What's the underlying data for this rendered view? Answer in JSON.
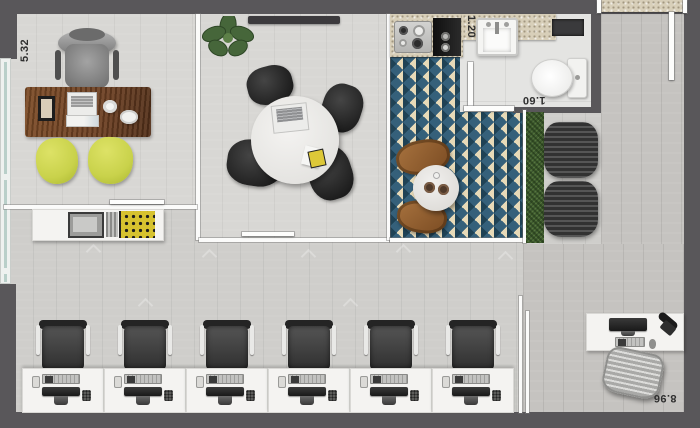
{
  "dimension_labels": {
    "office_width": "5.32",
    "bathroom_width": "1.20",
    "bathroom_depth": "1.60",
    "open_area_depth": "8.96"
  },
  "workstations": {
    "count": 6
  },
  "palette": {
    "wall": "#59575a",
    "floor_light": "#d8d7d4",
    "floor_open": "#cfcecb",
    "floor_corridor": "#c5c3c0",
    "tile_teal": "#35607a",
    "tile_navy": "#1f4255",
    "tile_cream": "#e7dab8",
    "counter_granite": "#d8cfb9",
    "desk_wood": "#6e4123",
    "chair_lime": "#c9d24b",
    "hedge_green": "#3f5a31"
  }
}
